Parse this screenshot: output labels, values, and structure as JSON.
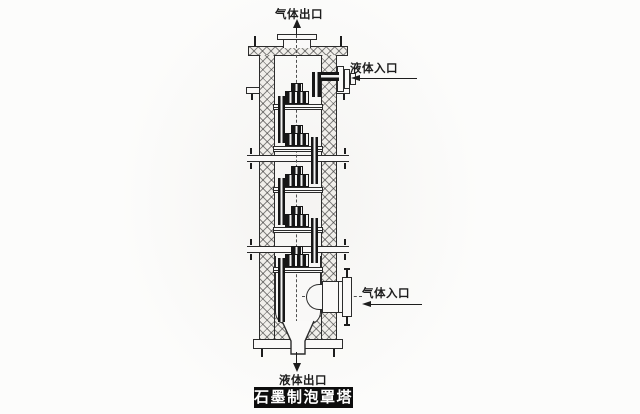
{
  "page": {
    "background": "#fcfcfb"
  },
  "diagram": {
    "type": "engineering_cross_section",
    "tray_count": 5
  },
  "labels": {
    "gas_outlet": "气体出口",
    "liquid_inlet": "液体入口",
    "gas_inlet": "气体入口",
    "liquid_outlet": "液体出口"
  },
  "banner": {
    "text": "石墨制泡罩塔"
  },
  "colors": {
    "line": "#2b2b2b",
    "dark_fill": "#1a1a1a",
    "banner_bg": "#0d0d0d",
    "banner_fg": "#ffffff",
    "paper": "#fcfcfb"
  }
}
